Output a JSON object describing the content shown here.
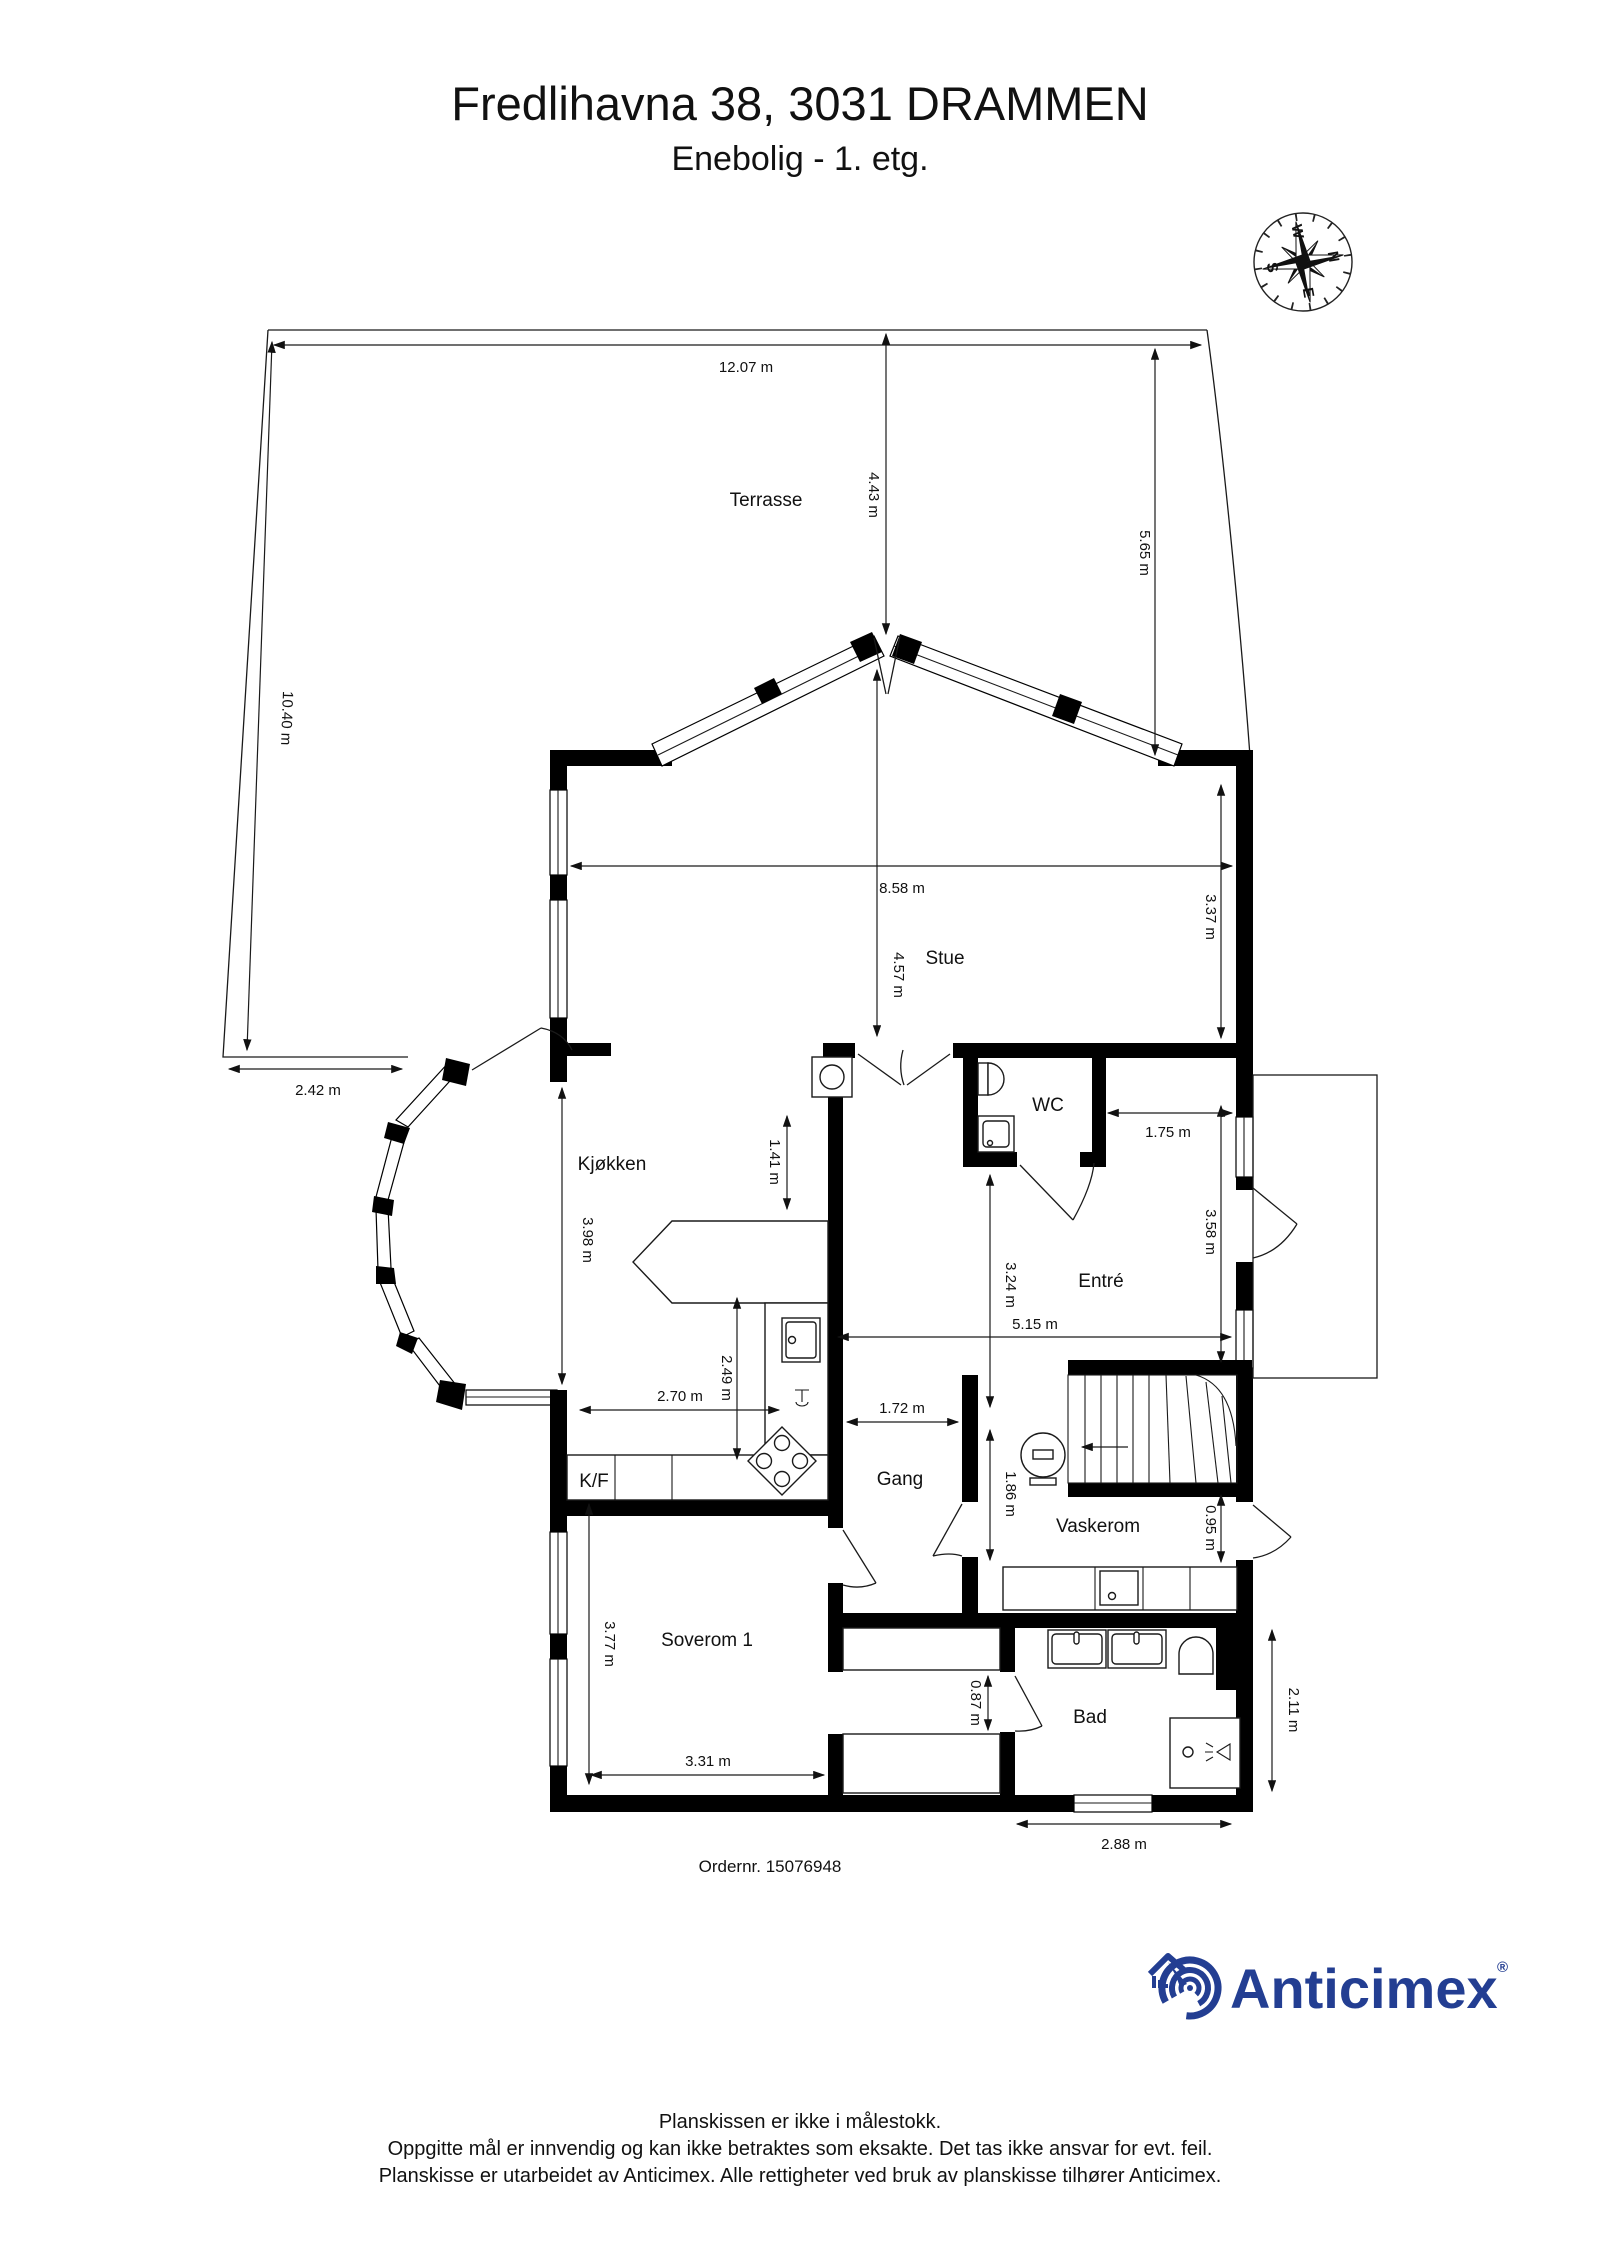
{
  "header": {
    "title": "Fredlihavna 38, 3031 DRAMMEN",
    "subtitle": "Enebolig - 1. etg."
  },
  "order": {
    "number_label": "Ordernr. 15076948"
  },
  "compass": {
    "n": "N",
    "e": "E",
    "s": "S",
    "w": "W"
  },
  "rooms": {
    "terrasse": {
      "label": "Terrasse"
    },
    "stue": {
      "label": "Stue"
    },
    "kjokken": {
      "label": "Kjøkken"
    },
    "wc": {
      "label": "WC"
    },
    "entre": {
      "label": "Entré"
    },
    "gang": {
      "label": "Gang"
    },
    "vaskerom": {
      "label": "Vaskerom"
    },
    "soverom1": {
      "label": "Soverom 1"
    },
    "bad": {
      "label": "Bad"
    },
    "kf": {
      "label": "K/F"
    }
  },
  "dims": {
    "d12_07": {
      "label": "12.07 m"
    },
    "d4_43": {
      "label": "4.43 m"
    },
    "d5_65": {
      "label": "5.65 m"
    },
    "d10_40": {
      "label": "10.40 m"
    },
    "d2_42": {
      "label": "2.42 m"
    },
    "d8_58": {
      "label": "8.58 m"
    },
    "d4_57": {
      "label": "4.57 m"
    },
    "d3_37": {
      "label": "3.37 m"
    },
    "d1_75": {
      "label": "1.75 m"
    },
    "d3_58": {
      "label": "3.58 m"
    },
    "d3_24": {
      "label": "3.24 m"
    },
    "d5_15": {
      "label": "5.15 m"
    },
    "d1_41": {
      "label": "1.41 m"
    },
    "d3_98": {
      "label": "3.98 m"
    },
    "d2_70": {
      "label": "2.70 m"
    },
    "d2_49": {
      "label": "2.49 m"
    },
    "d1_72": {
      "label": "1.72 m"
    },
    "d1_86": {
      "label": "1.86 m"
    },
    "d0_95": {
      "label": "0.95 m"
    },
    "d3_77": {
      "label": "3.77 m"
    },
    "d3_31": {
      "label": "3.31 m"
    },
    "d0_87": {
      "label": "0.87 m"
    },
    "d2_11": {
      "label": "2.11 m"
    },
    "d2_88": {
      "label": "2.88 m"
    }
  },
  "logo": {
    "brand": "Anticimex",
    "registered": "®"
  },
  "footer": {
    "line1": "Planskissen er ikke i målestokk.",
    "line2": "Oppgitte mål er innvendig og kan ikke betraktes som eksakte. Det tas ikke ansvar for evt. feil.",
    "line3": "Planskisse er utarbeidet av Anticimex. Alle rettigheter ved bruk av planskisse tilhører Anticimex."
  },
  "colors": {
    "wall": "#000000",
    "line": "#1a1a1a",
    "brand_blue": "#233e92",
    "background": "#ffffff"
  }
}
